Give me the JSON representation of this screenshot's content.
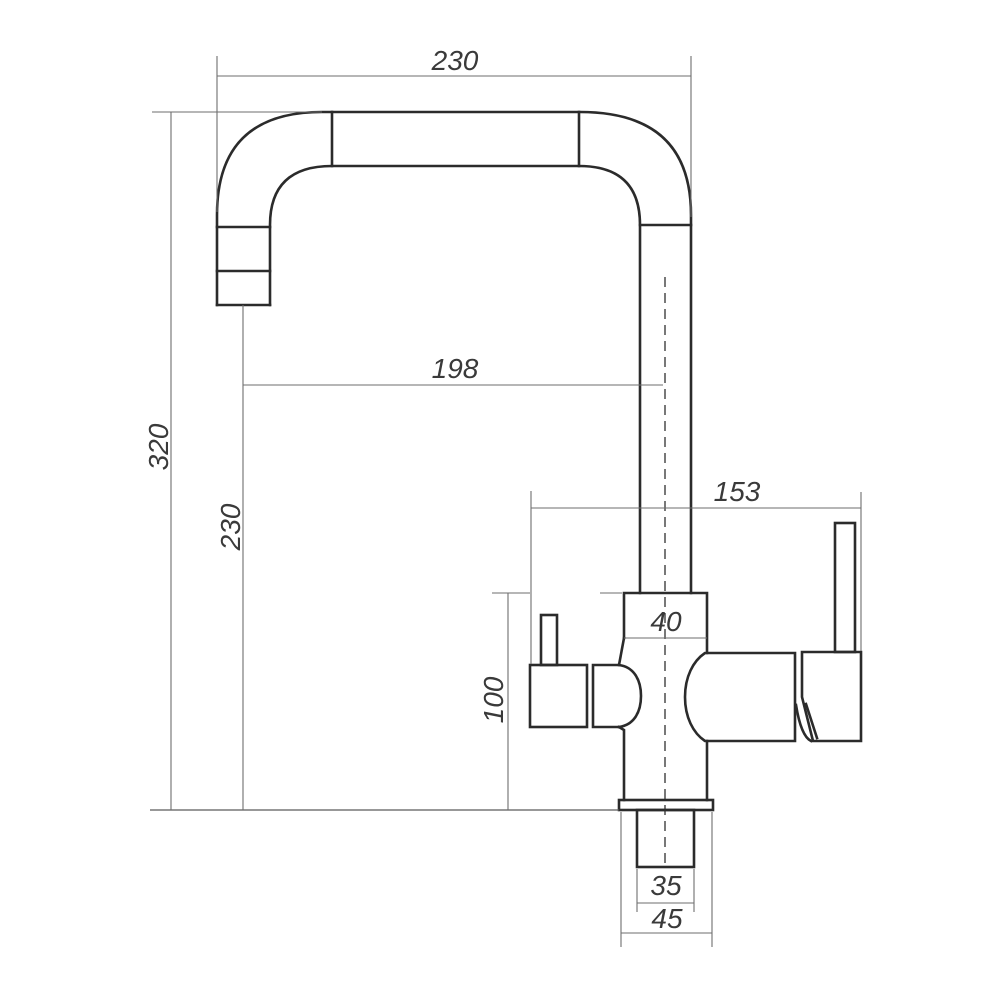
{
  "drawing": {
    "type": "technical-dimension-drawing",
    "subject": "kitchen-faucet-side-elevation",
    "background_color": "#ffffff",
    "outline_color": "#2b2b2b",
    "dimension_line_color": "#6e6e6e",
    "label_color": "#3a3a3a",
    "dimensions": {
      "spout_top_width": "230",
      "total_height": "320",
      "spout_drop_height": "230",
      "spout_reach": "198",
      "handle_span": "153",
      "body_diameter": "40",
      "body_height": "100",
      "shank_width": "35",
      "base_width": "45"
    }
  }
}
